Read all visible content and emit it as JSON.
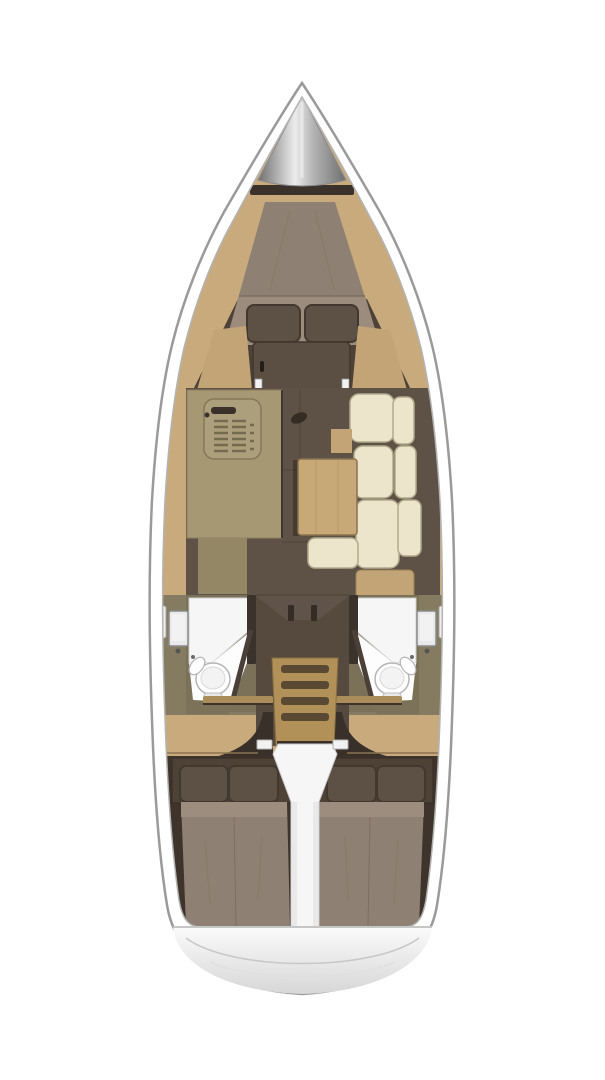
{
  "meta": {
    "title": "Sailboat interior layout plan",
    "view": "top-down",
    "orientation": "bow-up"
  },
  "palette": {
    "background": "#ffffff",
    "hull_outline": "#9a9a9a",
    "hull_white": "#ffffff",
    "lining_edge": "#b3b3b3",
    "wood": "#c9aa7d",
    "wood_seat": "#c3a476",
    "table_wood": "#c7a877",
    "door_brown": "#5b4e43",
    "cabin_dark": "#4e4237",
    "aft_dark": "#3e342b",
    "floor_brown": "#5e5145",
    "floor_seam": "#51453a",
    "mid_floor": "#564a3f",
    "mattress": "#8e8072",
    "mattress_light": "#9c8d7e",
    "pillow": "#5d5045",
    "pillow_edge": "#43382f",
    "cushion": "#ece5cb",
    "cushion_edge": "#b3aa8d",
    "galley_counter": "#a69872",
    "galley_counter_dark": "#948766",
    "sink_face": "#aca07c",
    "fixture_dark": "#3a322a",
    "stair_wood": "#b29158",
    "stair_groove": "#4f4130",
    "head_wall": "#857b61",
    "head_wall_panel": "#7b7158",
    "head_wall_dark": "#3b332b",
    "white_surface": "#f6f6f6",
    "floor_white": "#fdfdfd",
    "porcelain": "#ffffff",
    "glass": "#e9e9e9",
    "metal_light": "#ececec",
    "metal_mid": "#b5b5b5",
    "metal_dark": "#6f6f6f",
    "transom_light": "#fbfbfb",
    "transom_shade": "#d7d7d7",
    "shadow_dark": "#39302a",
    "white_trim": "#f2f2f2"
  },
  "regions": {
    "hull": "hull outline",
    "anchor_locker": "bow anchor locker",
    "v_berth": "forward V-berth double bed",
    "forward_cabin_door": "forward cabin door",
    "galley": "galley counter with sink",
    "salon": "salon floor",
    "salon_sofa": "L-shaped settee",
    "salon_table": "salon table",
    "port_head": "port head with toilet and shower",
    "starboard_head": "starboard head with toilet and shower",
    "companionway": "companionway steps",
    "port_aft_cabin": "port aft double berth",
    "starboard_aft_cabin": "starboard aft double berth",
    "engine_box": "engine compartment divider",
    "transom": "stern transom"
  }
}
